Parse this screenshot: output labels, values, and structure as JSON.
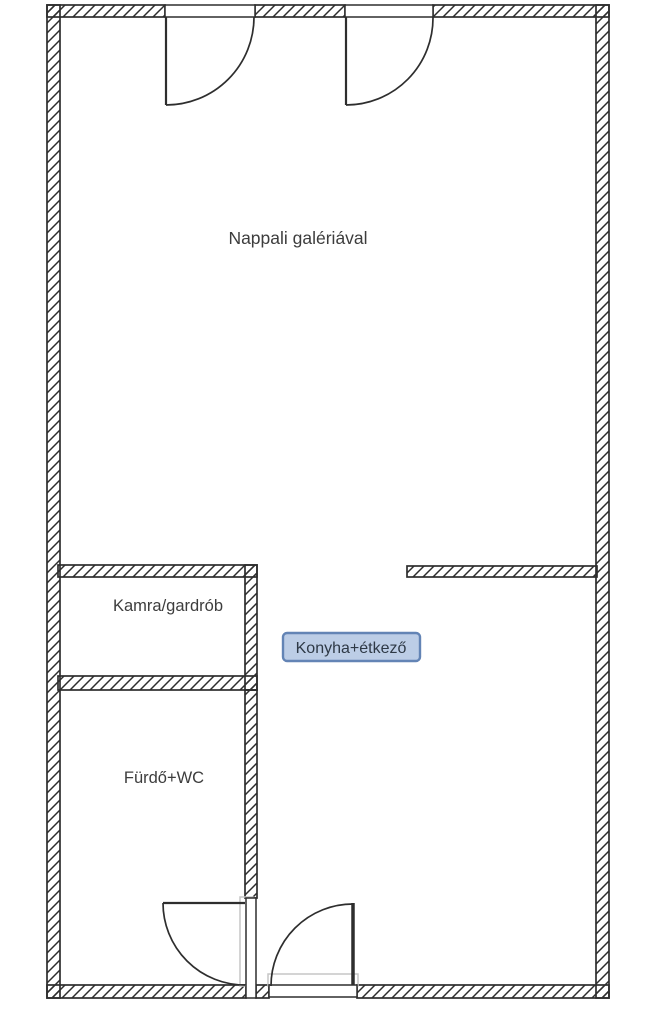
{
  "floor_plan": {
    "rooms": {
      "nappali": {
        "label": "Nappali galériával",
        "highlighted": false
      },
      "kamra": {
        "label": "Kamra/gardrób",
        "highlighted": false
      },
      "konyha": {
        "label": "Konyha+étkező",
        "highlighted": true
      },
      "furdo": {
        "label": "Fürdő+WC",
        "highlighted": false
      }
    },
    "colors": {
      "wall_line": "#2e2e2e",
      "label_text": "#3d3d3d",
      "highlight_fill": "#bccde6",
      "highlight_border": "#6384b5",
      "highlight_text": "#2e3946",
      "door_frame": "#c6c6c6",
      "background": "#ffffff"
    },
    "door_count": 4
  }
}
